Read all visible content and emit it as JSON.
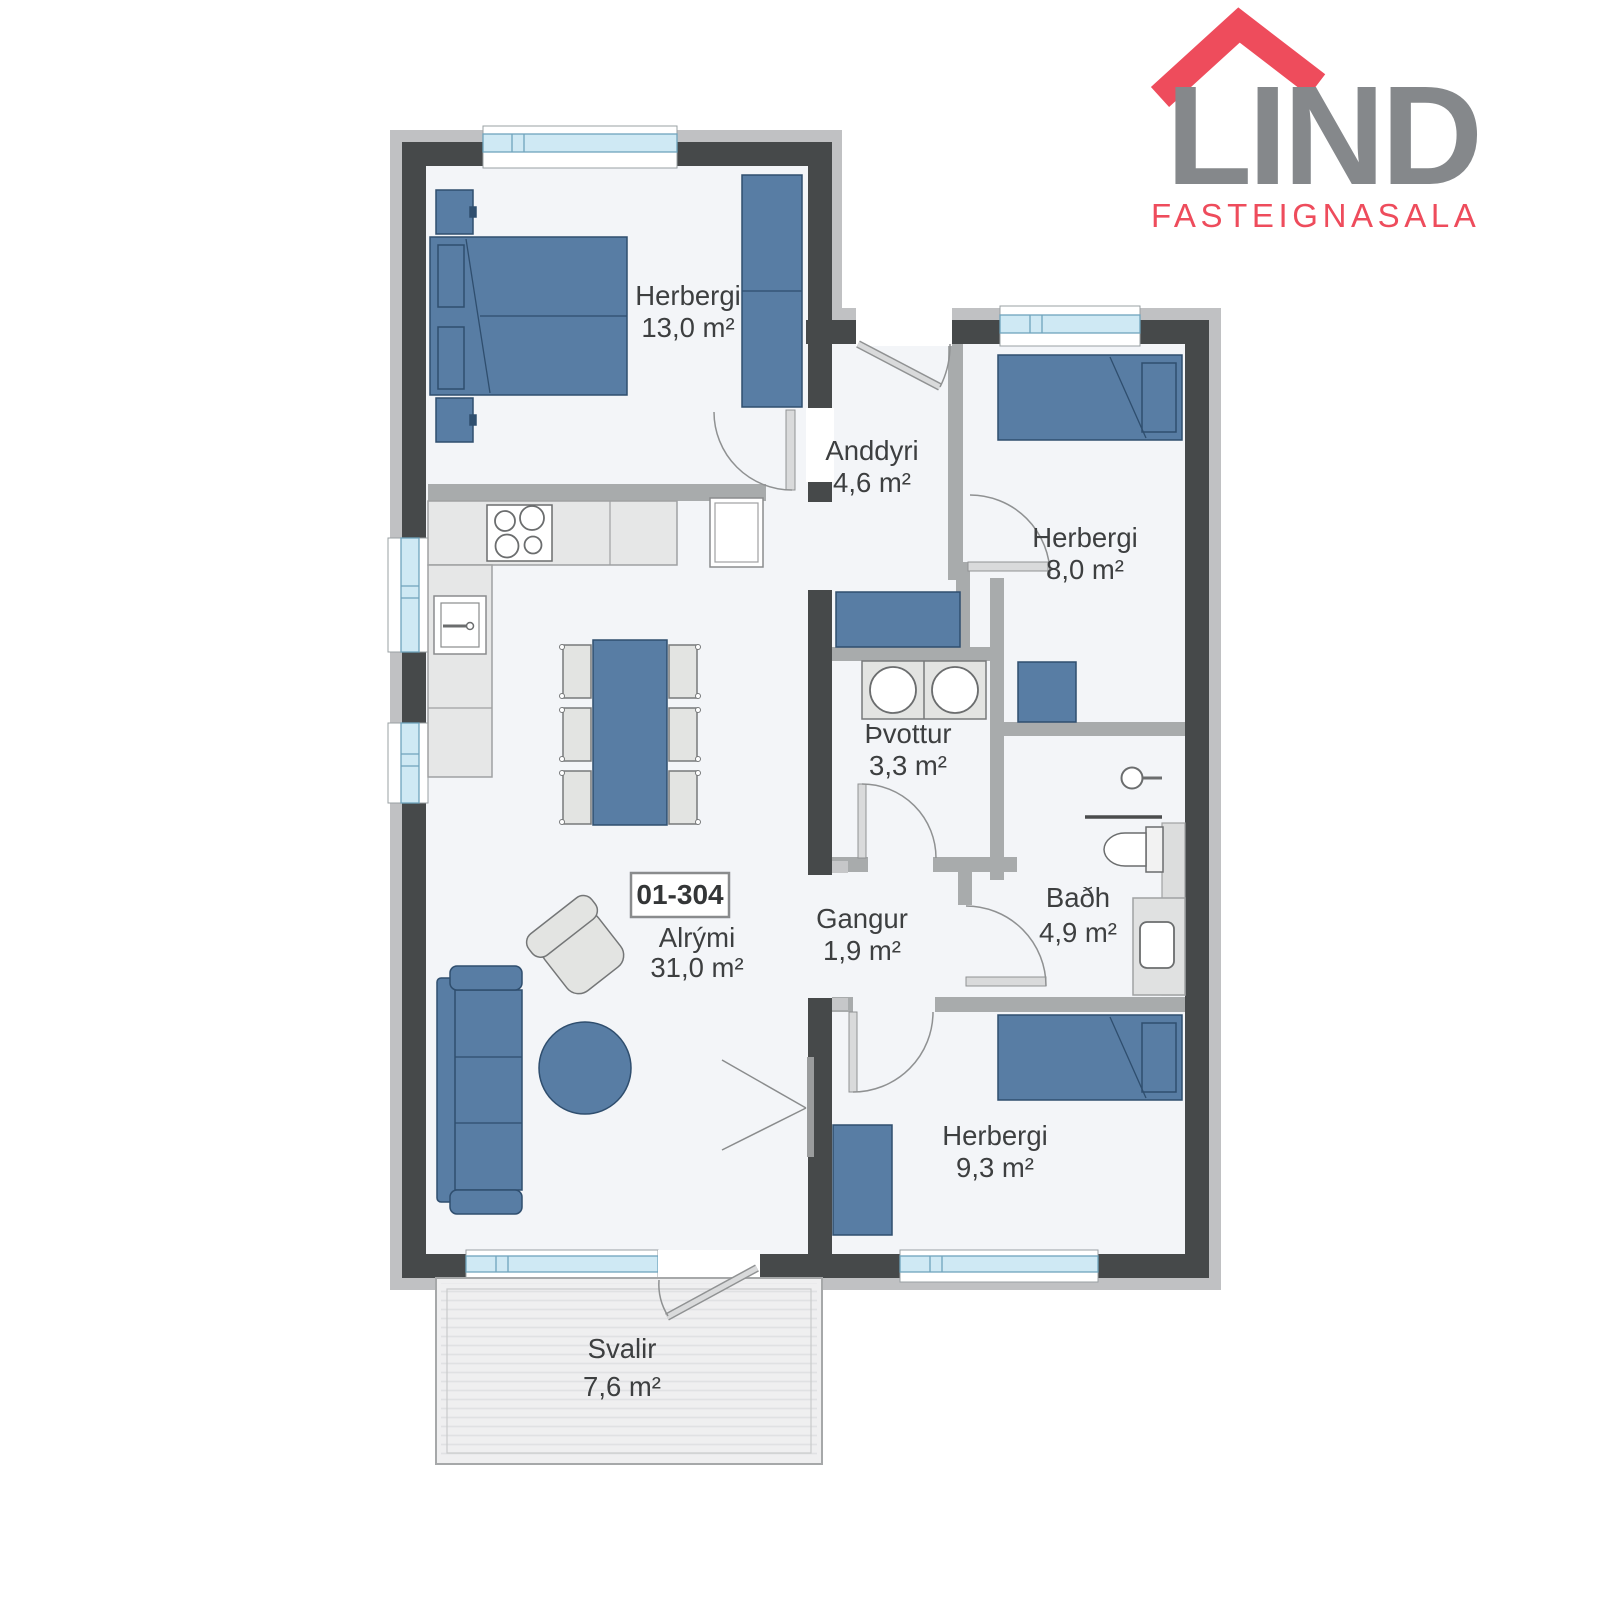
{
  "logo": {
    "brand": "LIND",
    "subtitle": "FASTEIGNASALA",
    "brand_color": "#85888b",
    "accent_color": "#ee4c5c",
    "roof_icon": "red house-roof chevron over LI letters"
  },
  "unit": {
    "label": "01-304"
  },
  "rooms": [
    {
      "id": "herbergi-13",
      "name": "Herbergi",
      "area": "13,0 m²"
    },
    {
      "id": "anddyri",
      "name": "Anddyri",
      "area": "4,6 m²"
    },
    {
      "id": "herbergi-8",
      "name": "Herbergi",
      "area": "8,0 m²"
    },
    {
      "id": "thvottur",
      "name": "Þvottur",
      "area": "3,3 m²"
    },
    {
      "id": "gangur",
      "name": "Gangur",
      "area": "1,9 m²"
    },
    {
      "id": "badh",
      "name": "Baðh",
      "area": "4,9 m²"
    },
    {
      "id": "alrymi",
      "name": "Alrými",
      "area": "31,0 m²"
    },
    {
      "id": "herbergi-9",
      "name": "Herbergi",
      "area": "9,3 m²"
    },
    {
      "id": "svalir",
      "name": "Svalir",
      "area": "7,6 m²"
    }
  ],
  "colors": {
    "wall_exterior": "#46494a",
    "wall_interior": "#a8abac",
    "wall_trim": "#c0c1c3",
    "floor": "#f3f5f8",
    "furniture_blue": "#587da4",
    "furniture_blue_stroke": "#2f4e6e",
    "furniture_gray": "#e3e4e2",
    "window_glass": "#cfe9f4",
    "deck": "#efeff0",
    "label_text": "#3d3f40"
  }
}
